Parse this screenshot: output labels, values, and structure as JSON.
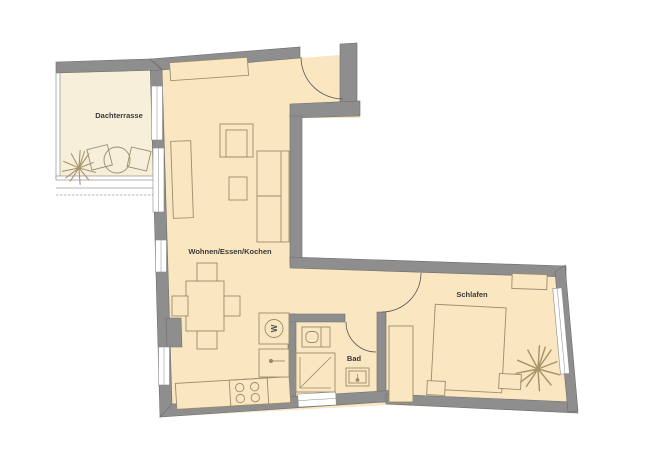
{
  "plan_title": "Apartment floor plan",
  "rooms": {
    "terrace": {
      "label": "Dachterrasse"
    },
    "living": {
      "label": "Wohnen/Essen/Kochen"
    },
    "bath": {
      "label": "Bad"
    },
    "bedroom": {
      "label": "Schlafen"
    }
  },
  "appliances": {
    "washing_machine": "W"
  },
  "colors": {
    "background": "#ffffff",
    "floor": "#fae6c0",
    "terrace_floor": "#f8efdb",
    "wall": "#8e8e8e",
    "wall_edge": "#6d6d6d",
    "furniture_line": "#9a8c6d",
    "door_line": "#555555",
    "plant_line": "#a8946a",
    "label_text": "#3a3a3a"
  }
}
